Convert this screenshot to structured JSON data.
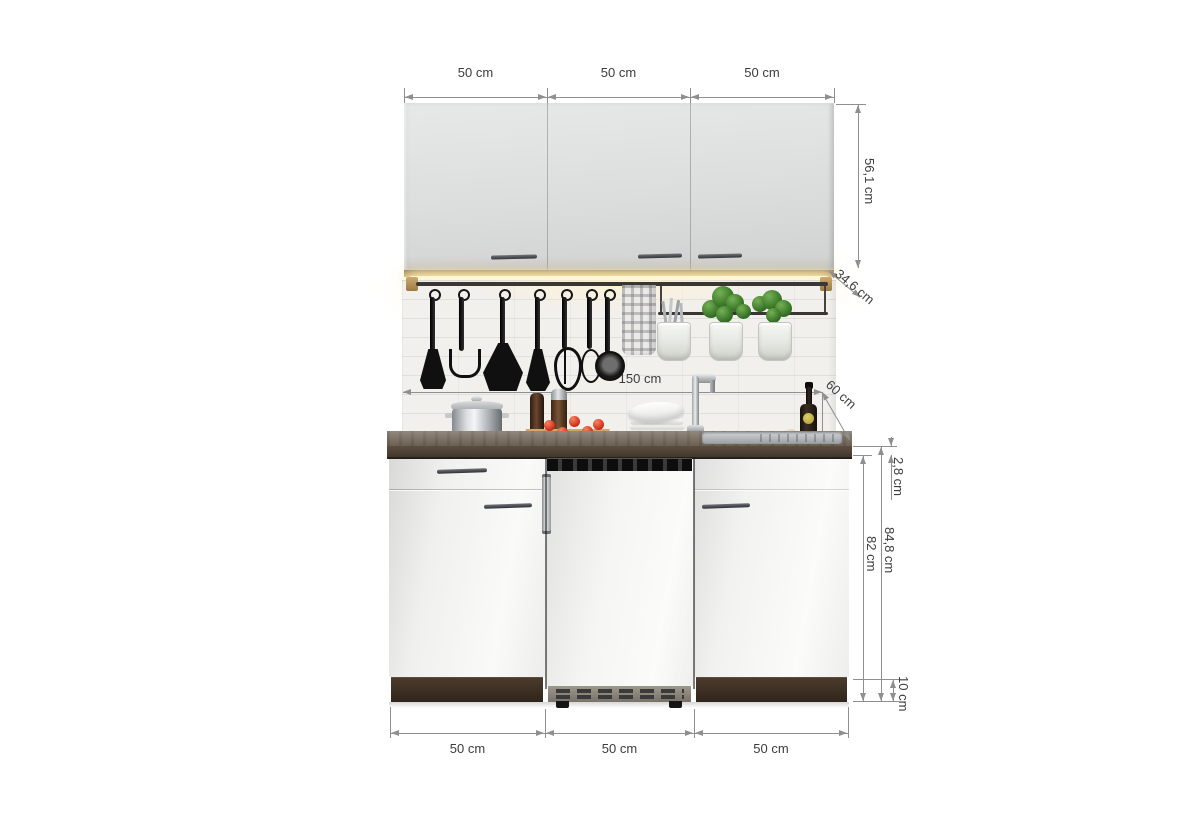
{
  "title": "Single-row kitchenette 150 cm with dimension annotations",
  "dims": {
    "top": [
      "50 cm",
      "50 cm",
      "50 cm"
    ],
    "bottom": [
      "50 cm",
      "50 cm",
      "50 cm"
    ],
    "wall_unit_height": "56,1 cm",
    "wall_unit_depth": "34,6 cm",
    "total_width": "150 cm",
    "worktop_depth": "60 cm",
    "worktop_thickness": "2,8 cm",
    "base_total_height": "84,8 cm",
    "base_unit_height": "82 cm",
    "plinth_height": "10 cm"
  },
  "colors": {
    "background": "#ffffff",
    "dimension_line": "#8f8f8f",
    "dimension_text": "#3c3c3c",
    "wall_cabinet_front": "#dfe0e0",
    "base_cabinet_front": "#f4f4f3",
    "worktop_top": "#7a6d5f",
    "worktop_front": "#4a3c30",
    "plinth_wood": "#3b2d22",
    "tile": "#f2f0ed",
    "led_glow": "#fff3cd",
    "utensil_black": "#111111",
    "herb_green": "#3f7d2e",
    "bucket_white": "#eef0ec",
    "tomato_red": "#d4301c",
    "board_wood": "#c79d62",
    "stainless_steel": "#b9bcbe",
    "wine_label": "#cdbd4e"
  },
  "items": [
    "wall-cabinet-left",
    "wall-cabinet-middle",
    "wall-cabinet-right",
    "under-cabinet-led-strip",
    "tile-backsplash",
    "utensil-rail",
    "slotted-spatula",
    "potato-masher",
    "wide-spatula",
    "turner",
    "whisk",
    "small-whisk",
    "skimmer",
    "kitchen-towel",
    "herb-rail",
    "cutlery-bucket",
    "herb-bucket-1",
    "herb-bucket-2",
    "cooking-pot",
    "hob",
    "spice-grinder-dark",
    "spice-grinder-steel",
    "cutting-board",
    "tomatoes",
    "plate-stack",
    "faucet",
    "sink",
    "garlic",
    "wine-bottle",
    "base-unit-drawer-door",
    "refrigerator",
    "base-unit-door",
    "worktop",
    "plinth-left",
    "plinth-right"
  ]
}
